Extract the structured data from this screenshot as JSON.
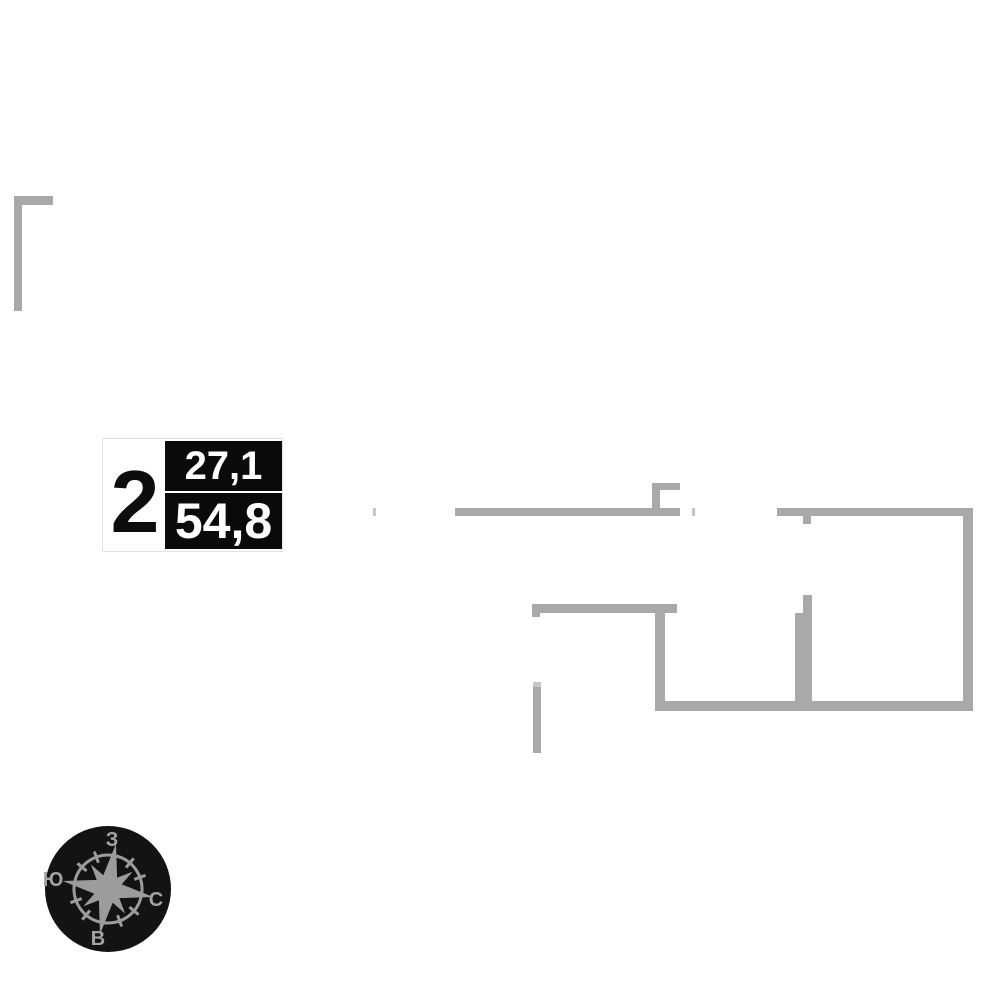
{
  "page": {
    "background": "#ffffff"
  },
  "unit": {
    "rooms": "2",
    "area_top": "27,1",
    "area_bottom": "54,8",
    "box_color": "#0a0a0a",
    "text_color": "#ffffff"
  },
  "compass": {
    "top": "З",
    "left": "Ю",
    "right": "С",
    "bottom": "В",
    "disc_color": "#131313",
    "star_color": "#9c9c9c",
    "letter_color": "#a3a3a3"
  },
  "plan": {
    "wall_color": "#a9a9a9",
    "light_tick_color": "#c6c6c6",
    "walls": [
      {
        "x": 14,
        "y": 196,
        "w": 8,
        "h": 115,
        "shade": "dark"
      },
      {
        "x": 14,
        "y": 196,
        "w": 39,
        "h": 9,
        "shade": "dark"
      },
      {
        "x": 373,
        "y": 508,
        "w": 3,
        "h": 8,
        "shade": "light"
      },
      {
        "x": 455,
        "y": 508,
        "w": 225,
        "h": 8,
        "shade": "dark"
      },
      {
        "x": 652,
        "y": 483,
        "w": 8,
        "h": 25,
        "shade": "dark"
      },
      {
        "x": 652,
        "y": 483,
        "w": 28,
        "h": 7,
        "shade": "dark"
      },
      {
        "x": 692,
        "y": 508,
        "w": 3,
        "h": 8,
        "shade": "light"
      },
      {
        "x": 777,
        "y": 508,
        "w": 196,
        "h": 8,
        "shade": "dark"
      },
      {
        "x": 803,
        "y": 516,
        "w": 8,
        "h": 8,
        "shade": "dark"
      },
      {
        "x": 963,
        "y": 508,
        "w": 10,
        "h": 203,
        "shade": "dark"
      },
      {
        "x": 532,
        "y": 604,
        "w": 145,
        "h": 9,
        "shade": "dark"
      },
      {
        "x": 532,
        "y": 613,
        "w": 8,
        "h": 4,
        "shade": "dark"
      },
      {
        "x": 655,
        "y": 604,
        "w": 10,
        "h": 107,
        "shade": "dark"
      },
      {
        "x": 655,
        "y": 701,
        "w": 318,
        "h": 10,
        "shade": "dark"
      },
      {
        "x": 803,
        "y": 595,
        "w": 9,
        "h": 106,
        "shade": "dark"
      },
      {
        "x": 795,
        "y": 613,
        "w": 8,
        "h": 88,
        "shade": "dark"
      },
      {
        "x": 533,
        "y": 682,
        "w": 8,
        "h": 5,
        "shade": "light"
      },
      {
        "x": 533,
        "y": 687,
        "w": 8,
        "h": 66,
        "shade": "dark"
      }
    ]
  }
}
